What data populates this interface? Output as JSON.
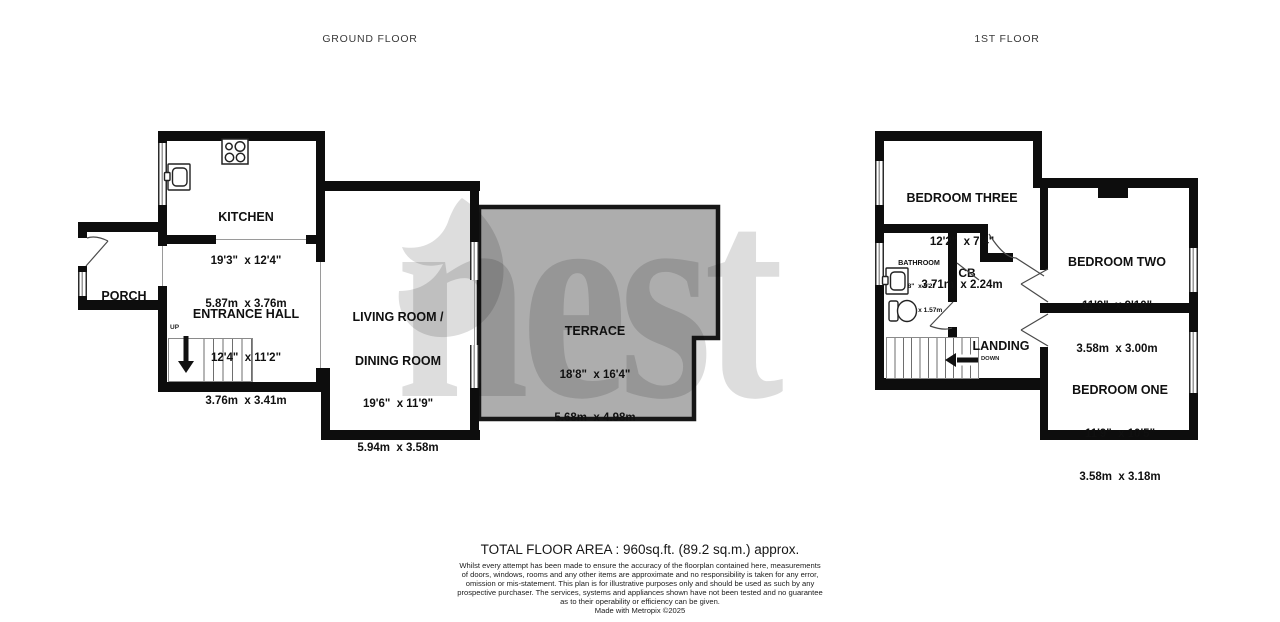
{
  "titles": {
    "ground": "GROUND FLOOR",
    "first": "1ST FLOOR"
  },
  "watermark": {
    "text": "nest"
  },
  "ground": {
    "kitchen": {
      "name": "KITCHEN",
      "imperial": "19'3\"  x 12'4\"",
      "metric": "5.87m  x 3.76m"
    },
    "entrance_hall": {
      "name": "ENTRANCE HALL",
      "imperial": "12'4\"  x 11'2\"",
      "metric": "3.76m  x 3.41m"
    },
    "porch": {
      "name": "PORCH"
    },
    "living_dining": {
      "name_line1": "LIVING ROOM /",
      "name_line2": "DINING ROOM",
      "imperial": "19'6\"  x 11'9\"",
      "metric": "5.94m  x 3.58m"
    },
    "terrace": {
      "name": "TERRACE",
      "imperial": "18'8\"  x 16'4\"",
      "metric": "5.68m  x 4.98m"
    },
    "stairs_label": "UP"
  },
  "first": {
    "bedroom_three": {
      "name": "BEDROOM THREE",
      "imperial": "12'2\"  x 7'4\"",
      "metric": "3.71m  x 2.24m"
    },
    "bathroom": {
      "name": "BATHROOM",
      "imperial": "8'8\"  x 5'2\"",
      "metric": "2.64m  x 1.57m"
    },
    "cupboard": {
      "name": "CB"
    },
    "bedroom_two": {
      "name": "BEDROOM TWO",
      "imperial": "11'9\"  x 9'10\"",
      "metric": "3.58m  x 3.00m"
    },
    "landing": {
      "name": "LANDING"
    },
    "bedroom_one": {
      "name": "BEDROOM ONE",
      "imperial": "11'9\"  x 10'5\"",
      "metric": "3.58m  x 3.18m"
    },
    "stairs_label": "DOWN"
  },
  "footer": {
    "total_area": "TOTAL FLOOR AREA : 960sq.ft. (89.2 sq.m.) approx.",
    "disclaimer_line1": "Whilst every attempt has been made to ensure the accuracy of the floorplan contained here, measurements",
    "disclaimer_line2": "of doors, windows, rooms and any other items are approximate and no responsibility is taken for any error,",
    "disclaimer_line3": "omission or mis-statement. This plan is for illustrative purposes only and should be used as such by any",
    "disclaimer_line4": "prospective purchaser. The services, systems and appliances shown have not been tested and no guarantee",
    "disclaimer_line5": "as to their operability or efficiency can be given.",
    "made_with": "Made with Metropix ©2025"
  },
  "colors": {
    "wall": "#0d0d0d",
    "terrace_fill": "#adadad",
    "watermark_gray": "#d9d9d9"
  }
}
